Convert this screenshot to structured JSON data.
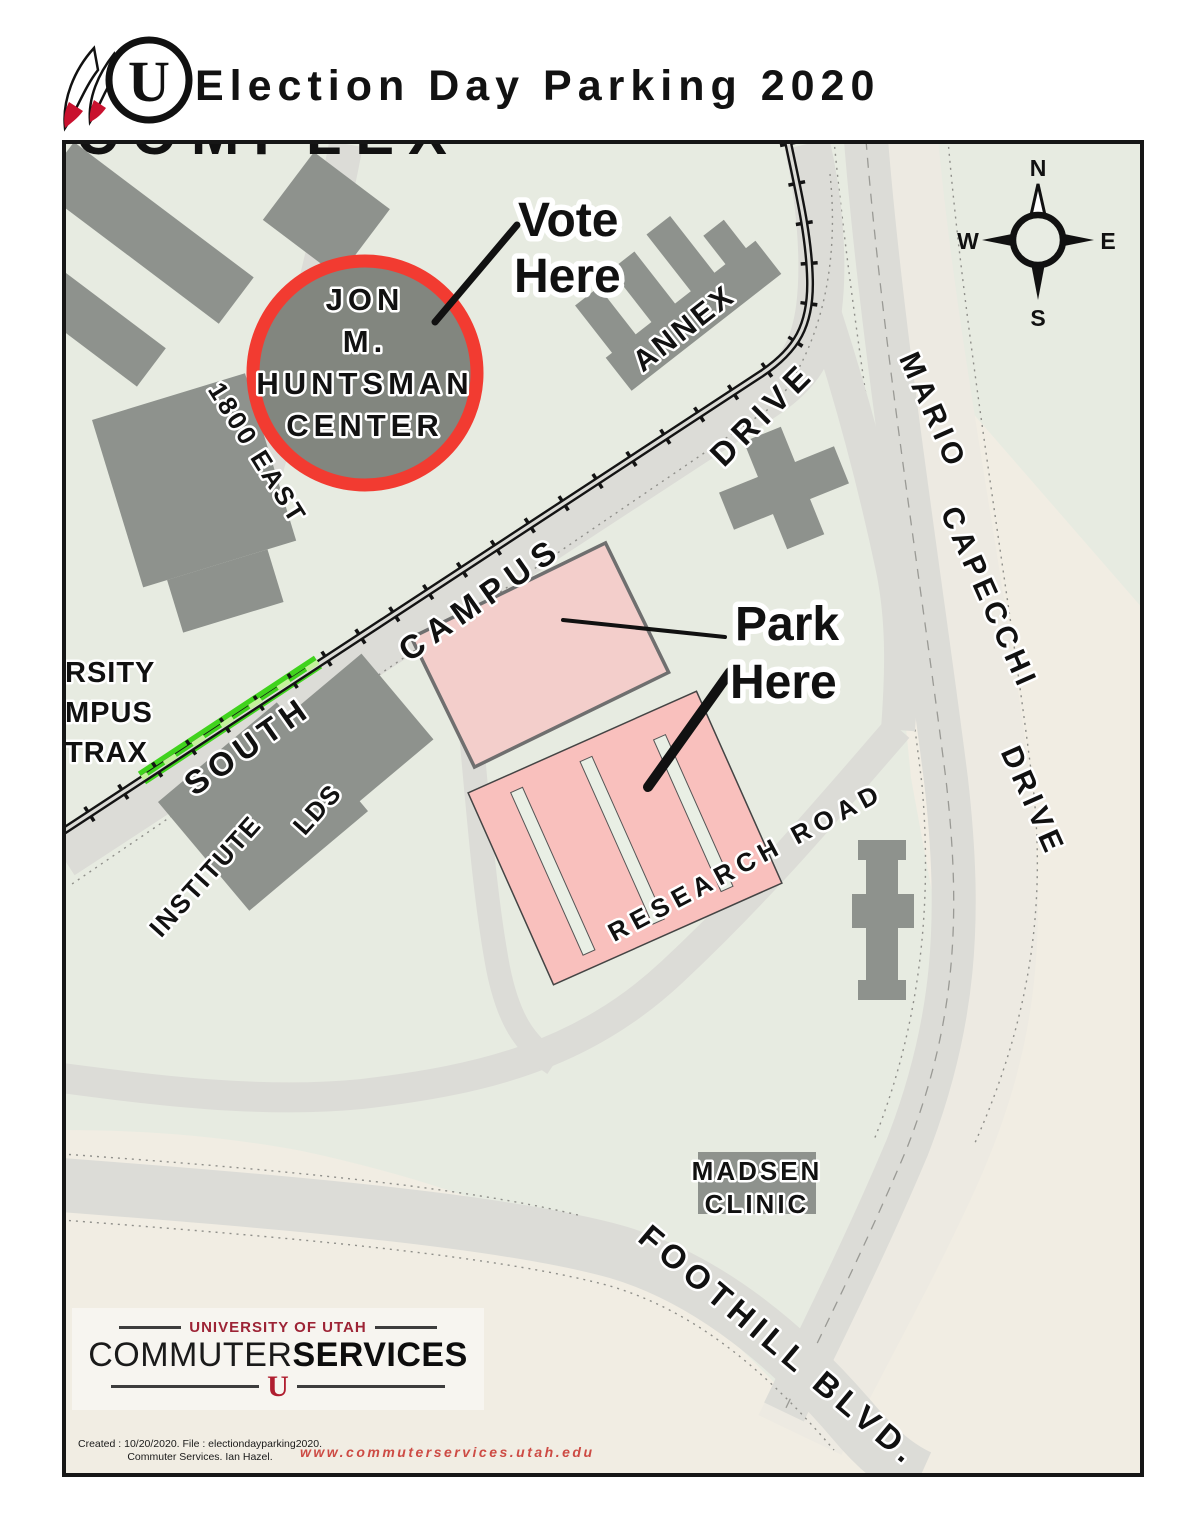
{
  "header": {
    "title": "Election Day Parking 2020",
    "logo_letter": "U"
  },
  "map": {
    "labels": {
      "complex": "COMPLEX",
      "vote_line1": "Vote",
      "vote_line2": "Here",
      "park_line1": "Park",
      "park_line2": "Here",
      "huntsman_lines": [
        "JON",
        "M.",
        "HUNTSMAN",
        "CENTER"
      ],
      "annex": "ANNEX",
      "campus": "CAMPUS",
      "drive": "DRIVE",
      "south": "SOUTH",
      "east_1800": "1800 EAST",
      "mario": "MARIO",
      "capecchi": "CAPECCHI",
      "mario_drive": "DRIVE",
      "research_road": "RESEARCH ROAD",
      "foothill": "FOOTHILL BLVD.",
      "madsen_line1": "MADSEN",
      "madsen_line2": "CLINIC",
      "lds": "LDS",
      "institute": "INSTITUTE",
      "trax_lines": [
        "RSITY",
        "MPUS",
        "TRAX"
      ],
      "compass": {
        "n": "N",
        "e": "E",
        "s": "S",
        "w": "W"
      }
    },
    "colors": {
      "map_background": "#e7ebe1",
      "beige_land": "#f1ede3",
      "road_gray": "#dcdcd7",
      "building_gray": "#8e928d",
      "huntsman_fill": "#82867f",
      "huntsman_ring_red": "#f23b31",
      "vote_park_red": "#a41623",
      "pink_building": "#f3cecb",
      "pink_parking": "#f9c0bd",
      "trax_green": "#40d31d"
    }
  },
  "footer": {
    "logo_top": "UNIVERSITY OF UTAH",
    "logo_main_regular": "COMMUTER",
    "logo_main_bold": "SERVICES",
    "logo_u": "U",
    "created_line1": "Created : 10/20/2020. File : electiondayparking2020.",
    "created_line2": "Commuter Services. Ian Hazel.",
    "website": "www.commuterservices.utah.edu"
  }
}
